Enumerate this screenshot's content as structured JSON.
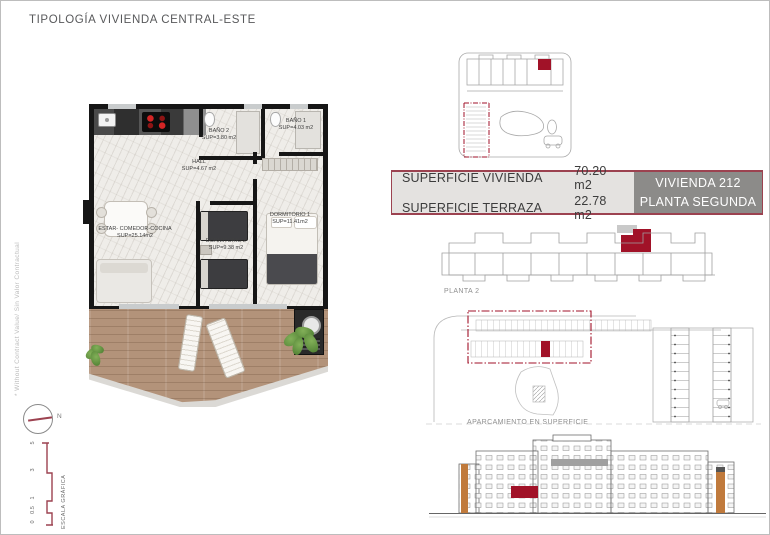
{
  "page": {
    "title": "TIPOLOGÍA VIVIENDA CENTRAL-ESTE",
    "side_note": "* Without Contract Value/ Sin Valor Contractual"
  },
  "colors": {
    "accent_red": "#A11228",
    "maroon": "#9C4250",
    "table_left_bg": "#E4E2E0",
    "table_right_bg": "#8C8B89",
    "title_gray": "#58595B"
  },
  "floorplan": {
    "rooms": [
      {
        "name": "ESTAR- COMEDOR-COCINA",
        "area": "SUP=25.14m2"
      },
      {
        "name": "HALL",
        "area": "SUP=4.67 m2"
      },
      {
        "name": "BAÑO 2",
        "area": "SUP=3.80 m2"
      },
      {
        "name": "BAÑO 1",
        "area": "SUP=4.03 m2"
      },
      {
        "name": "DORMITORIO 2",
        "area": "SUP=9.38 m2"
      },
      {
        "name": "DORMITORIO 1",
        "area": "SUP=11.41m2"
      }
    ]
  },
  "summary_table": {
    "rows": [
      {
        "label": "SUPERFICIE VIVIENDA",
        "value": "70.20 m2"
      },
      {
        "label": "SUPERFICIE TERRAZA",
        "value": "22.78 m2"
      }
    ],
    "unit_label": "VIVIENDA 212",
    "floor_label": "PLANTA SEGUNDA"
  },
  "diagrams": {
    "floor_strip_label": "PLANTA 2",
    "parking_label": "APARCAMIENTO EN SUPERFICIE"
  },
  "scale": {
    "label": "ESCALA GRÁFICA",
    "ticks": [
      "0",
      "0.5",
      "1",
      "3",
      "5"
    ],
    "north_label": "N"
  }
}
